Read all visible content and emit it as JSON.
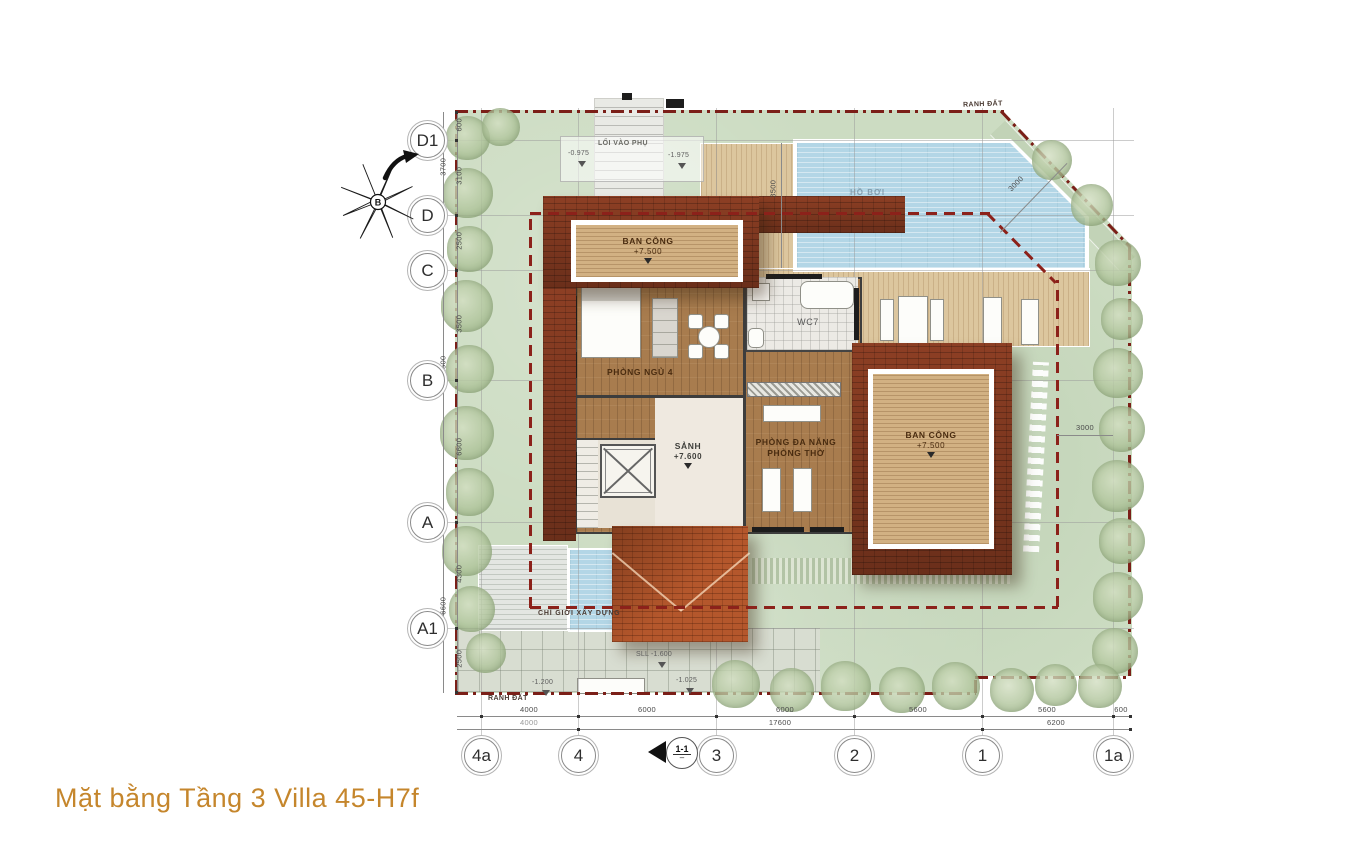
{
  "title": "Mặt bằng Tầng 3 Villa 45-H7f",
  "compass": {
    "north_label": "B"
  },
  "grid": {
    "rows": [
      "D1",
      "D",
      "C",
      "B",
      "A",
      "A1"
    ],
    "cols": [
      "4a",
      "4",
      "3",
      "2",
      "1",
      "1a"
    ],
    "section_marker": "1-1"
  },
  "dimensions": {
    "left_outer": [
      "3700",
      "12500",
      "6600"
    ],
    "left_inner": [
      "600",
      "3100",
      "2500",
      "3500",
      "6600",
      "4300",
      "2500"
    ],
    "bottom_upper": [
      "4000",
      "6000",
      "6000",
      "5600",
      "5600",
      "600"
    ],
    "bottom_lower": [
      "4000",
      "17600",
      "6200"
    ],
    "right_gap": "3000",
    "pool_width": "3500",
    "corner_diagonal": "3000"
  },
  "rooms": {
    "balcony_top": {
      "label": "BAN CÔNG",
      "elev": "+7.500"
    },
    "bedroom": {
      "label": "PHÒNG NGỦ 4"
    },
    "wc": {
      "label": "WC7"
    },
    "hall": {
      "label": "SẢNH",
      "elev": "+7.600"
    },
    "multi": {
      "label": "PHÒNG ĐA NĂNG",
      "label2": "PHÒNG THỜ"
    },
    "balcony_right": {
      "label": "BAN CÔNG",
      "elev": "+7.500"
    }
  },
  "site": {
    "boundary_top": "RANH ĐẤT",
    "boundary_bottom": "RANH ĐẤT",
    "construction_line": "CHỈ GIỚI XÂY DỰNG",
    "side_entry": "LỐI VÀO PHỤ",
    "pool": "HỒ BƠI",
    "marks": [
      "-0.975",
      "-1.975",
      "SLL -1.600",
      "-1.200",
      "-1.025"
    ]
  },
  "colors": {
    "title": "#c5862c",
    "roof_dark": "#79351e",
    "roof_bright": "#b4572c",
    "pool": "#b3d6e6",
    "lawn": "#ccdcc2",
    "boundary": "#7b1f18"
  }
}
